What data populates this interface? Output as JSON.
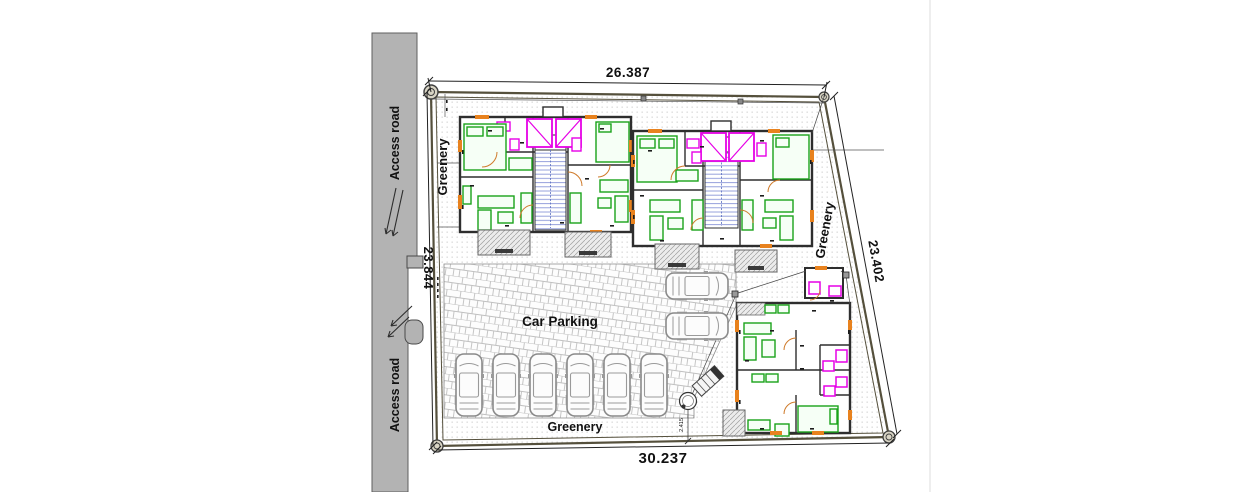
{
  "drawing": {
    "dimensions": {
      "top": "26.387",
      "left": "23.844",
      "right": "23.402",
      "bottom": "30.237",
      "circle_offset": "2.415"
    },
    "labels": {
      "access_road_top": "Access road",
      "access_road_bottom": "Access road",
      "greenery_left": "Greenery",
      "greenery_right": "Greenery",
      "greenery_bottom": "Greenery",
      "car_parking": "Car Parking"
    },
    "colors": {
      "road": "#b3b3b3",
      "boundary_wall": "#55503c",
      "building_wall": "#2e2e2e",
      "furniture": "#1aa31a",
      "sanitary": "#e600e6",
      "stairs": "#7b8fd4",
      "accent": "#e8821e",
      "paver_joint": "#c0c0c0",
      "greenery_dot": "#c6c6c6",
      "text": "#111111"
    }
  }
}
